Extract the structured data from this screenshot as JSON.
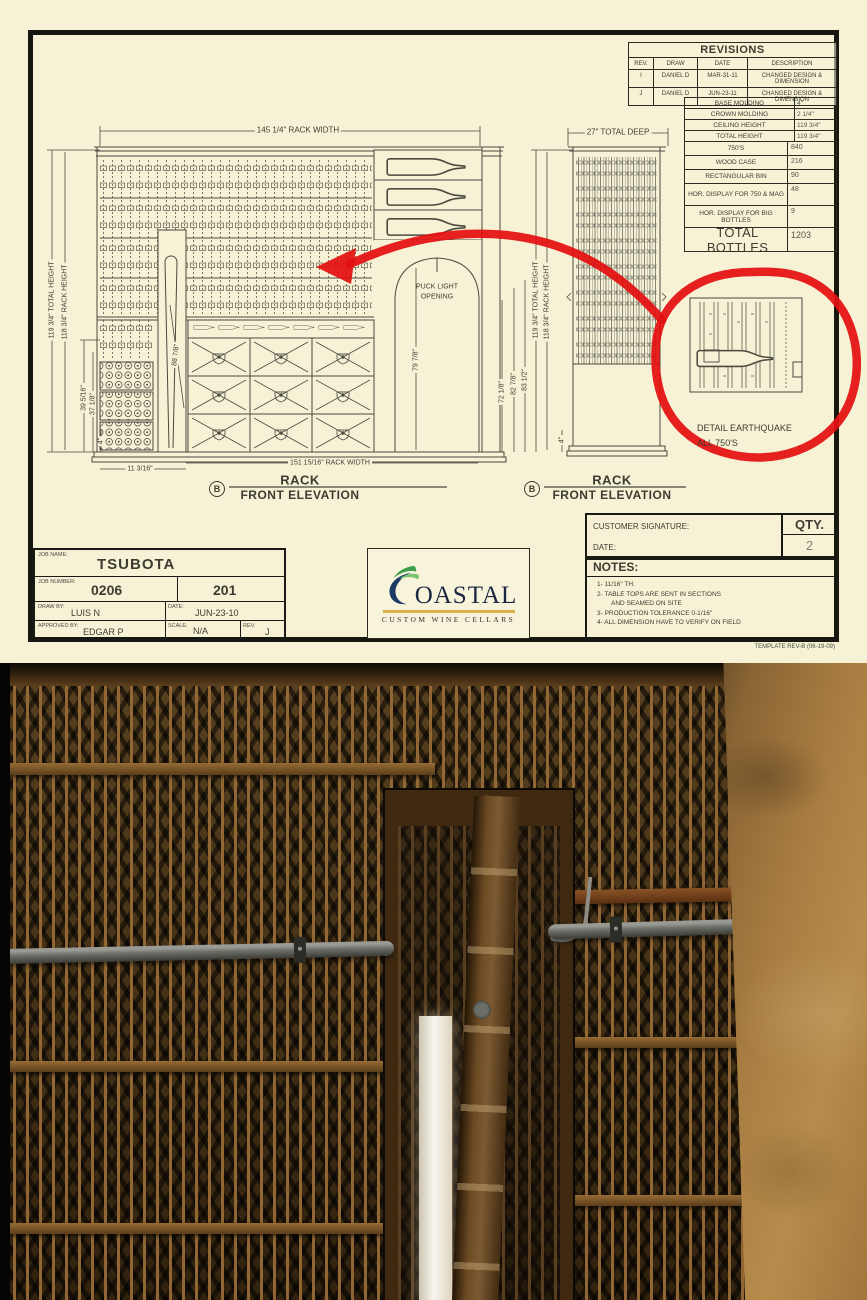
{
  "sheet": {
    "revisions": {
      "title": "REVISIONS",
      "headers": [
        "REV.",
        "DRAW",
        "DATE",
        "DESCRIPTION"
      ],
      "rows": [
        [
          "I",
          "DANIEL D",
          "MAR-31-11",
          "CHANGED DESIGN & DIMENSION"
        ],
        [
          "J",
          "DANIEL D",
          "JUN-23-11",
          "CHANGED DESIGN & DIMENSION"
        ]
      ]
    },
    "specs": {
      "rows": [
        {
          "label": "BASE MOLDING",
          "value": "4\""
        },
        {
          "label": "CROWN MOLDING",
          "value": "2 1/4\""
        },
        {
          "label": "CEILING HEIGHT",
          "value": "119 3/4\""
        },
        {
          "label": "TOTAL HEIGHT",
          "value": "119 3/4\""
        }
      ]
    },
    "counts": {
      "rows": [
        {
          "label": "750'S",
          "value": "840"
        },
        {
          "label": "WOOD CASE",
          "value": "216"
        },
        {
          "label": "RECTANGULAR BIN",
          "value": "90"
        },
        {
          "label": "HOR. DISPLAY FOR 750 & MAG",
          "value": "48"
        },
        {
          "label": "HOR. DISPLAY FOR BIG BOTTLES",
          "value": "9"
        }
      ],
      "total_label": "TOTAL BOTTLES",
      "total_value": "1203"
    },
    "dims": {
      "rack_width_top": "145 1/4\" RACK WIDTH",
      "total_deep": "27\" TOTAL DEEP",
      "total_height_left": "119 3/4\" TOTAL HEIGHT",
      "rack_height_left": "118 3/4\" RACK HEIGHT",
      "d39": "39 5/16\"",
      "d37": "37 1/8\"",
      "d4_left": "4\"",
      "d88": "88 7/8\"",
      "d79": "79 7/8\"",
      "d72": "72 1/8\"",
      "d82": "82 7/8\"",
      "d83": "83 1/2\"",
      "total_height_right": "119 3/4\" TOTAL HEIGHT",
      "rack_height_right": "118 3/4\" RACK HEIGHT",
      "d4_right": "4\"",
      "d11": "11 3/16\"",
      "rack_width_bottom": "151 15/16\" RACK WIDTH"
    },
    "labels": {
      "puck_light_1": "PUCK LIGHT",
      "puck_light_2": "OPENING",
      "detail_1": "DETAIL EARTHQUAKE",
      "detail_2": "ALL 750'S",
      "elev_marker": "B",
      "elev_title": "RACK",
      "elev_subtitle": "FRONT ELEVATION"
    },
    "signature": {
      "customer_label": "CUSTOMER SIGNATURE:",
      "date_label": "DATE:",
      "qty_label": "QTY.",
      "qty_value": "2"
    },
    "titleblock": {
      "job_name_label": "JOB NAME:",
      "job_name": "TSUBOTA",
      "job_number_label": "JOB NUMBER:",
      "job_number": "0206",
      "sheet_number": "201",
      "draw_by_label": "DRAW BY:",
      "draw_by": "LUIS N",
      "date_label": "DATE:",
      "date": "JUN-23-10",
      "approved_label": "APPROVED BY:",
      "approved": "EDGAR P",
      "scale_label": "SCALE:",
      "scale": "N/A",
      "rev_label": "REV.",
      "rev": "J"
    },
    "logo": {
      "wordmark": "OASTAL",
      "tagline": "CUSTOM WINE CELLARS"
    },
    "notes": {
      "title": "NOTES:",
      "lines": [
        "1- 11/16\" TH.",
        "2- TABLE TOPS ARE SENT IN SECTIONS",
        "AND SEAMED ON SITE",
        "3- PRODUCTION TOLERANCE 0-1/16\"",
        "4- ALL DIMENSION HAVE TO VERIFY ON FIELD"
      ]
    },
    "template_rev": "TEMPLATE REV-B (06-19-09)",
    "colors": {
      "paper": "#f7f2d6",
      "annotation_red": "#e31010",
      "logo_navy": "#1c3a66",
      "logo_green": "#3f9e4e",
      "logo_gold": "#d9b34a"
    }
  }
}
